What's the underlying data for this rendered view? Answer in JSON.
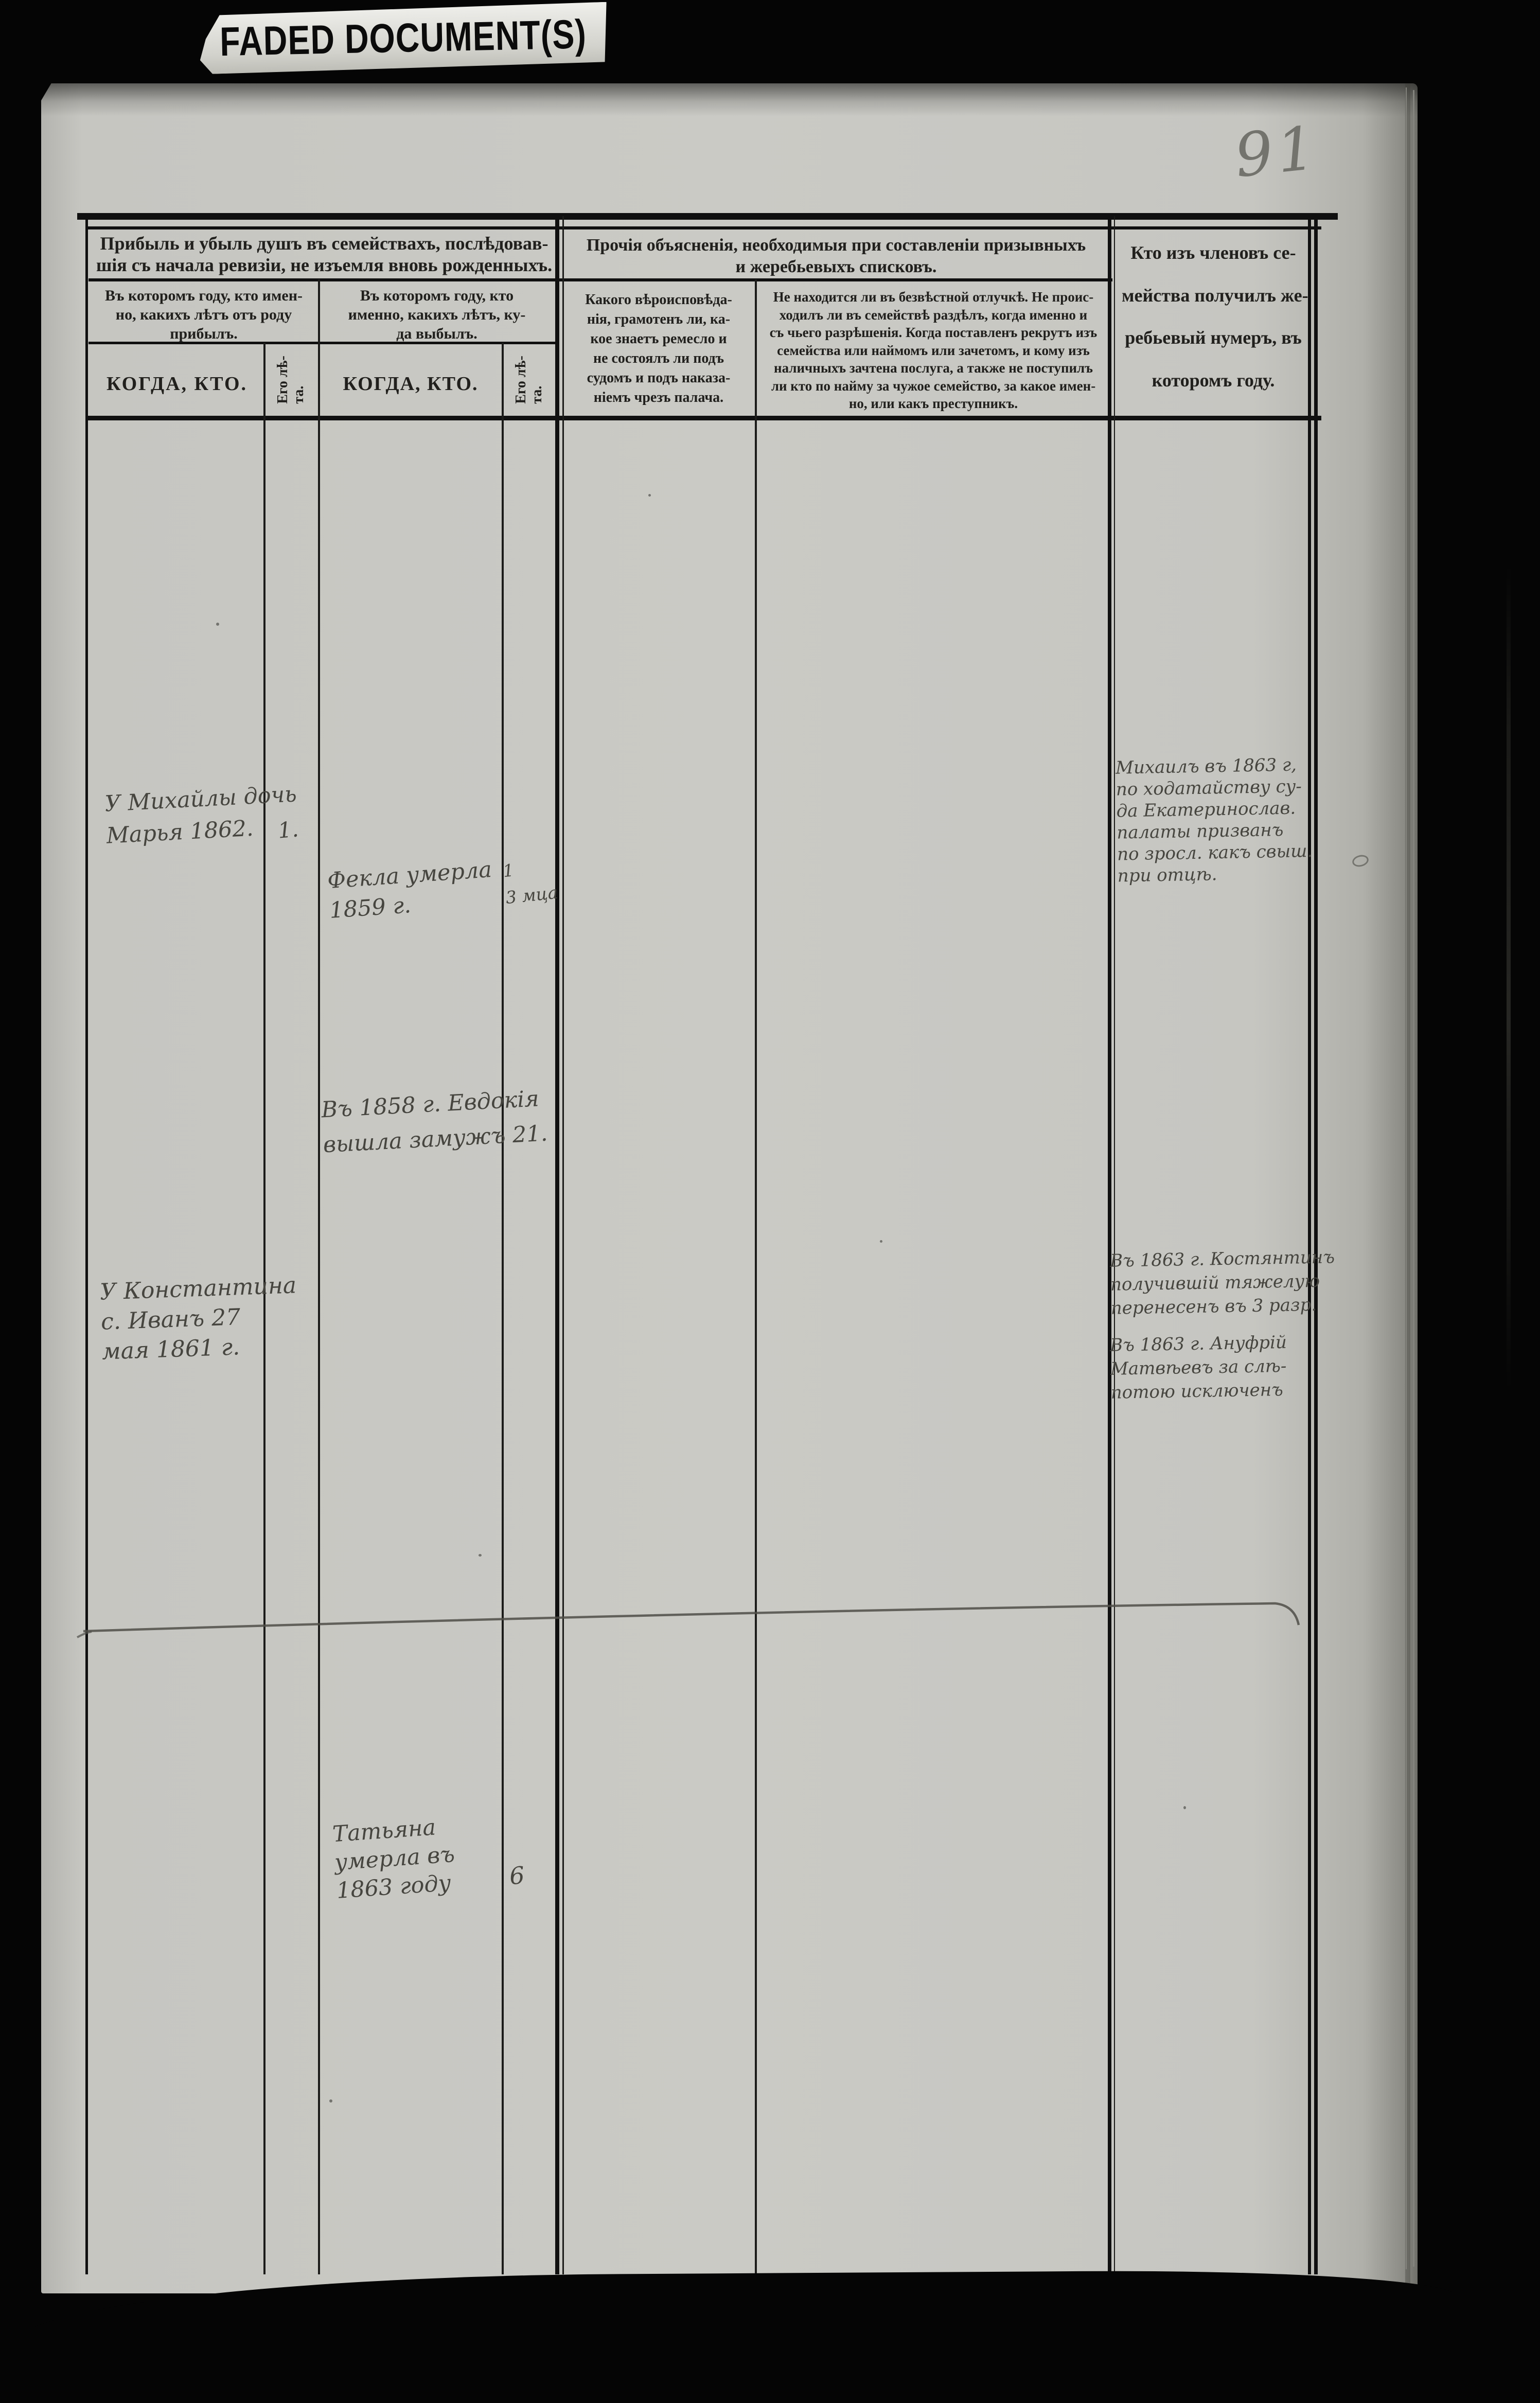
{
  "colors": {
    "background": "#050505",
    "paper": "#cacac5",
    "printed_ink": "#21201d",
    "handwriting_ink": "#46453f",
    "pencil": "#73736d"
  },
  "banner": {
    "label": "FADED DOCUMENT(S)"
  },
  "page": {
    "number": "91"
  },
  "table": {
    "group_arrival_loss": {
      "lines": [
        "Прибыль и убыль душъ въ семействахъ, послѣдовав-",
        "шія съ начала ревизіи, не изъемля вновь рожденныхъ."
      ]
    },
    "group_other_notes": {
      "lines": [
        "Прочія объясненія, необходимыя при составленіи призывныхъ",
        "и жеребьевыхъ списковъ."
      ]
    },
    "group_lottery_number": {
      "lines": [
        "Кто изъ членовъ се-",
        "мейства получилъ же-",
        "ребьевый нумеръ, въ",
        "которомъ году."
      ]
    },
    "col_arrived": {
      "lines": [
        "Въ которомъ году, кто имен-",
        "но, какихъ лѣтъ отъ роду",
        "прибылъ."
      ]
    },
    "col_departed": {
      "lines": [
        "Въ которомъ году, кто",
        "именно, какихъ лѣтъ, ку-",
        "да выбылъ."
      ]
    },
    "col_when_who_arrived": "КОГДА,  КТО.",
    "col_when_who_departed": "КОГДА, КТО.",
    "col_age": {
      "lines": [
        "Его лѣ-",
        "та."
      ]
    },
    "col_faith": {
      "lines": [
        "Какого вѣроисповѣда-",
        "нія, грамотенъ ли, ка-",
        "кое знаетъ ремесло и",
        "не состоялъ ли подъ",
        "судомъ и подъ наказа-",
        "ніемъ чрезъ палача."
      ]
    },
    "col_absence": {
      "lines": [
        "Не находится ли въ безвѣстной отлучкѣ. Не проис-",
        "ходилъ ли въ семействѣ раздѣлъ, когда именно и",
        "съ чьего разрѣшенія. Когда поставленъ рекрутъ изъ",
        "семейства или наймомъ или зачетомъ, и кому изъ",
        "наличныхъ зачтена послуга, а также не поступилъ",
        "ли кто по найму за чужое семейство, за какое имен-",
        "но, или какъ преступникъ."
      ]
    }
  },
  "entries": {
    "arrived1": {
      "lines": [
        "У Михайлы дочь",
        "Марья 1862."
      ],
      "age": "1."
    },
    "departed1": {
      "lines": [
        "Фекла умерла",
        "1859 г."
      ],
      "age_lines": [
        "1",
        "3 мца"
      ]
    },
    "departed2": {
      "lines": [
        "Въ 1858 г. Евдокія",
        "вышла замужъ 21."
      ]
    },
    "arrived2": {
      "lines": [
        "У Константина",
        "с. Иванъ 27",
        "мая 1861 г."
      ]
    },
    "lottery1": {
      "lines": [
        "Михаилъ въ 1863 г,",
        "по ходатайству су-",
        "да Екатеринослав.",
        "палаты призванъ",
        "по зросл. какъ свыш.",
        "при отцѣ."
      ]
    },
    "lottery2": {
      "lines": [
        "Въ 1863 г. Костянтинъ",
        "получившій тяжелую",
        "перенесенъ въ 3 разр."
      ]
    },
    "lottery3": {
      "lines": [
        "Въ 1863 г. Ануфрій",
        "Матвѣевъ за слѣ-",
        "потою исключенъ"
      ]
    },
    "departed3": {
      "lines": [
        "Татьяна",
        "умерла въ",
        "1863 году"
      ],
      "age": "6"
    }
  }
}
